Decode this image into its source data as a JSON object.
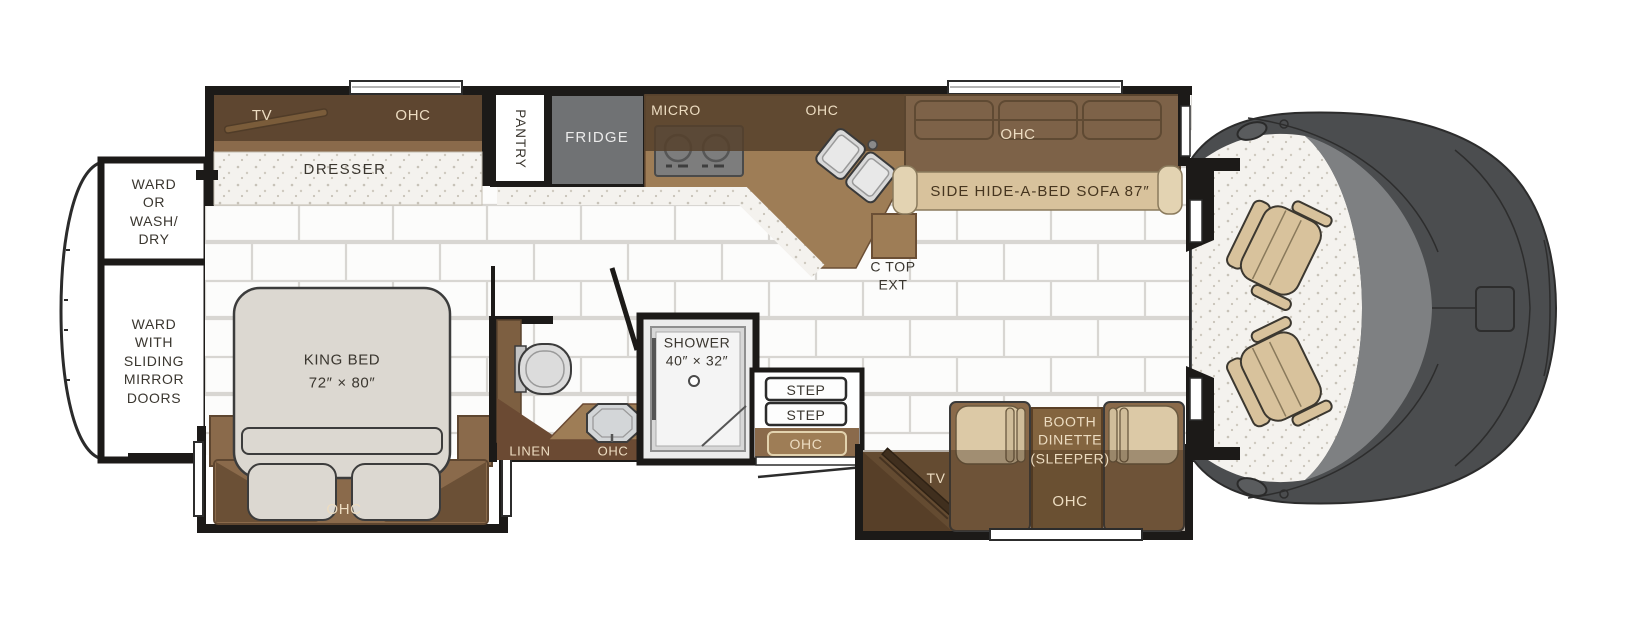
{
  "diagram": {
    "kind": "rv-motorhome-floorplan",
    "orientation": "cab-on-right"
  },
  "labels": {
    "bedroom_tv": "TV",
    "bedroom_ohc": "OHC",
    "dresser": "DRESSER",
    "ward_washdry": "WARD\nOR\nWASH/\nDRY",
    "ward_mirror": "WARD\nWITH\nSLIDING\nMIRROR\nDOORS",
    "king_bed": "KING BED\n72″ × 80″",
    "bed_ohc": "OHC",
    "pantry": "PANTRY",
    "fridge": "FRIDGE",
    "micro": "MICRO",
    "kitchen_ohc": "OHC",
    "ctop_ext": "C TOP\nEXT",
    "sofa": "SIDE HIDE-A-BED SOFA 87″",
    "sofa_ohc": "OHC",
    "linen": "LINEN",
    "vanity_ohc": "OHC",
    "shower": "SHOWER\n40″ × 32″",
    "step_1": "STEP",
    "step_2": "STEP",
    "entry_ohc": "OHC",
    "dinette_tv": "TV",
    "dinette": "BOOTH\nDINETTE\n(SLEEPER)",
    "dinette_ohc": "OHC"
  },
  "colors": {
    "wall": "#1c1a18",
    "cabinet_dark": "#5e4630",
    "cabinet_mid": "#9e7d56",
    "cabinet_light": "#8a6a4b",
    "upholstery_tan": "#d8c29c",
    "cushion_tan": "#dcc9a6",
    "bed_gray": "#dcd8d1",
    "appliance_gray": "#707274",
    "cab_body_gray": "#4b4d4f",
    "windshield_gray": "#7e8082",
    "label_cream": "#ecdcc1",
    "label_dark": "#3a362f"
  }
}
